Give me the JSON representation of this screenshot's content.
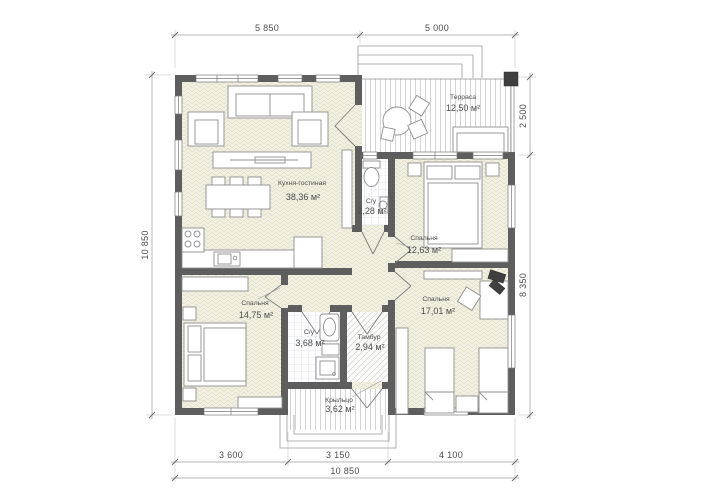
{
  "meta": {
    "type": "architectural-floor-plan",
    "language": "ru"
  },
  "colors": {
    "wall": "#5e5e5e",
    "floor_beige": "#f2f0e1",
    "floor_pattern": "#ddd8c2",
    "tile_line": "#c7d3dd",
    "deck_stripe": "#c9c9c9",
    "furniture_line": "#8f8f8f",
    "dimension_line": "#9b9b9b",
    "text": "#4d4d4d"
  },
  "rooms": {
    "terrace": {
      "name": "Терраса",
      "area": "12,50 м²"
    },
    "kitchen_living": {
      "name": "Кухня-гостиная",
      "area": "38,36 м²"
    },
    "wc_small": {
      "name": "С/у",
      "area": "2,28 м²"
    },
    "bedroom_right": {
      "name": "Спальня",
      "area": "12,63 м²"
    },
    "bedroom_left": {
      "name": "Спальня",
      "area": "14,75 м²"
    },
    "bedroom_bottom": {
      "name": "Спальня",
      "area": "17,01 м²"
    },
    "bathroom": {
      "name": "С/у",
      "area": "3,68 м²"
    },
    "tambour": {
      "name": "Тамбур",
      "area": "2,94 м²"
    },
    "porch": {
      "name": "Крыльцо",
      "area": "3,62 м²"
    }
  },
  "dimensions": {
    "top": [
      "5 850",
      "5 000"
    ],
    "left": [
      "10 850"
    ],
    "right": [
      "2 500",
      "8 350"
    ],
    "bottom": [
      "3 600",
      "3 150",
      "4 100"
    ],
    "bottom_total": "10 850"
  }
}
